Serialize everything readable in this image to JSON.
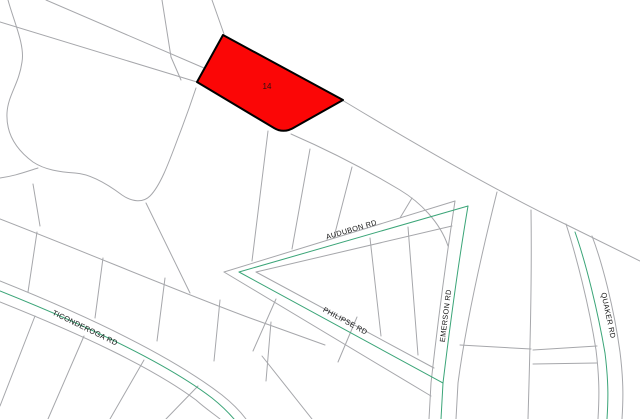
{
  "map": {
    "type": "parcel-map",
    "background_color": "#ffffff",
    "boundary_line_color": "#a6a7ab",
    "road_centerline_color": "#3ba578",
    "label_color": "#161616",
    "highlight_parcel": {
      "label": "14",
      "fill": "#fb0606",
      "outline": "#000000",
      "label_color": "#2e1212",
      "path": "M223,35 L343,100 L295,127 Q284,134 274,128 L197,82 Z",
      "label_x": 267,
      "label_y": 89
    },
    "roads": [
      {
        "id": "audubon-rd",
        "name": "AUDUBON RD",
        "label": {
          "x": 352,
          "y": 232,
          "rotate": -16.5
        },
        "center": "M239,272 L468,206"
      },
      {
        "id": "philipse-rd",
        "name": "PHILIPSE RD",
        "label": {
          "x": 344,
          "y": 323,
          "rotate": 28.5
        },
        "center": "M239,272 L443,383"
      },
      {
        "id": "emerson-rd",
        "name": "EMERSON RD",
        "label": {
          "x": 448,
          "y": 316,
          "rotate": -83
        },
        "center": "M468,206 C458,265 450,325 443,383 L441,419"
      },
      {
        "id": "ticonderoga-rd",
        "name": "TICONDEROGA RD",
        "label": {
          "x": 84,
          "y": 330,
          "rotate": 26
        },
        "center": "M0,291 C85,325 165,362 212,398 C222,406 228,412 234,419"
      },
      {
        "id": "quaker-rd",
        "name": "QUAKER RD",
        "label": {
          "x": 606,
          "y": 316,
          "rotate": 78
        },
        "center": "M575,232 C586,263 598,312 605,353 C609,385 608,403 607,419"
      }
    ],
    "boundaries": [
      "M46,0 L204,68",
      "M342,100 C420,147 500,193 567,225 L640,261",
      "M0,22 L197,82",
      "M291,134 C330,151 370,172 400,190 C420,202 440,222 448,246",
      "M212,0 L224,34",
      "M162,0 L171,57",
      "M171,57 L181,80",
      "M8,0 C14,22 25,45 22,62 C19,84 8,95 7,113 C6,132 14,148 33,162 C45,170 60,172 75,173 C92,174 110,186 122,195 C132,202 143,203 150,196 C160,186 168,165 178,138 C185,120 191,103 196,88",
      "M0,178 C15,176 25,172 38,168",
      "M0,219 C90,254 180,292 250,318 L325,345",
      "M37,232 L28,292",
      "M103,258 L95,318",
      "M165,278 L157,341",
      "M220,300 L214,361",
      "M271,322 L266,381",
      "M40,226 L33,184",
      "M146,203 L190,293",
      "M0,281 C85,315 170,355 222,395 C232,403 240,411 246,419",
      "M0,302 C80,334 150,366 196,400 C206,409 214,414 220,419",
      "M35,316 L0,406",
      "M84,336 L48,419",
      "M144,360 L110,419",
      "M198,386 L166,419",
      "M224,272 L455,201",
      "M256,272 L452,226",
      "M256,272 L434,368",
      "M224,272 L431,396",
      "M370,238 L381,336",
      "M408,227 L418,355",
      "M455,201 C446,260 438,320 431,383 L429,419",
      "M497,192 C480,260 465,330 458,383 L456,419",
      "M268,131 L252,261",
      "M310,149 L292,249",
      "M352,167 L334,237",
      "M412,198 L400,218",
      "M276,299 L253,351",
      "M357,317 L338,362",
      "M262,356 L312,419",
      "M566,224 C576,255 589,305 596,350 C600,382 599,402 598,419",
      "M592,236 C602,262 614,308 620,352 C624,384 623,403 622,419",
      "M531,210 C532,280 530,350 528,419",
      "M460,345 L531,349",
      "M533,350 L597,346",
      "M533,364 L597,363"
    ]
  }
}
